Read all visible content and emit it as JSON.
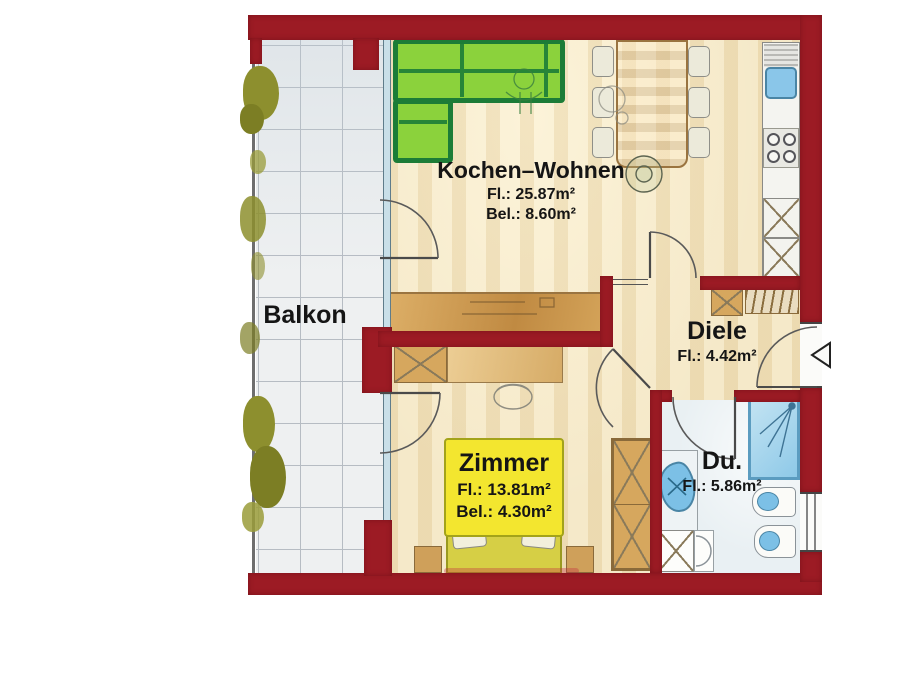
{
  "plan": {
    "type": "floorplan",
    "rooms": {
      "balkon": {
        "label": "Balkon"
      },
      "kochen_wohnen": {
        "label": "Kochen–Wohnen",
        "area": "Fl.: 25.87m²",
        "light_area": "Bel.: 8.60m²"
      },
      "diele": {
        "label": "Diele",
        "area": "Fl.: 4.42m²"
      },
      "zimmer": {
        "label": "Zimmer",
        "area": "Fl.: 13.81m²",
        "light_area": "Bel.: 4.30m²"
      },
      "dusche": {
        "label": "Du.",
        "area": "Fl.: 5.86m²"
      }
    },
    "colors": {
      "wall": "#9c1b24",
      "interior_floor": "#f2e4c0",
      "balcony_tile": "#eef0f1",
      "bath_floor": "#e9f0f3",
      "wood": "#d2a058",
      "sofa_fill": "#8bd23c",
      "sofa_border": "#1c7c37",
      "highlight_yellow": "#f3e62f",
      "fixture_blue": "#8ac6e9",
      "greenery": "#8d8f2e"
    },
    "furniture": [
      "corner-sofa",
      "dining-table",
      "dining-chairs",
      "kitchen-sink",
      "stove",
      "kitchen-cabinets",
      "sideboard",
      "desk",
      "desk-chair",
      "bed",
      "pillows",
      "bedside-tables",
      "wardrobe",
      "shoe-cabinet",
      "coat-rack",
      "shower",
      "bathroom-sink",
      "washing-machine",
      "bidet",
      "toilet",
      "balcony-plants"
    ]
  }
}
